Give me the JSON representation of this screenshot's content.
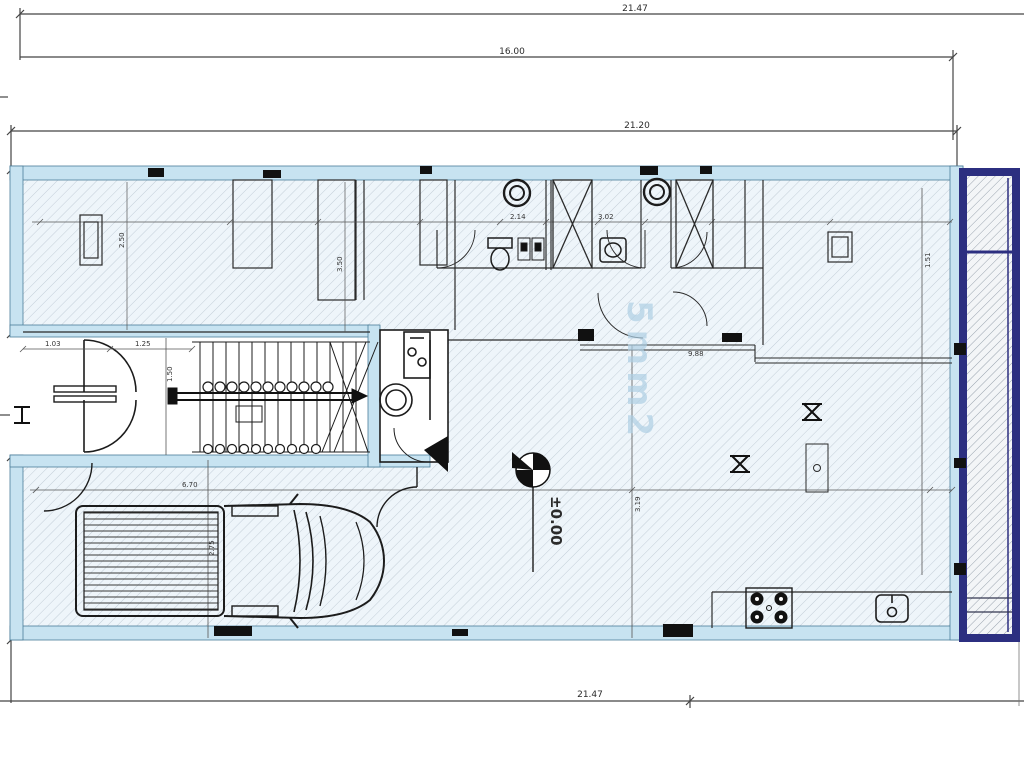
{
  "plan": {
    "watermark": "5mm2",
    "level_marker": "±0.00"
  },
  "labels": {
    "dim_overall_top": "21.47",
    "dim_upper": "16.00",
    "dim_inner_top": "21.20",
    "dim_overall_bottom": "21.47",
    "dim_hall_h": "2.50",
    "dim_hall_h2": "3.50",
    "dim_bath_1": "2.14",
    "dim_bath_2": "3.02",
    "dim_entry_1": "1.03",
    "dim_entry_2": "1.25",
    "dim_stair": "1.50",
    "dim_garage": "6.70",
    "dim_living": "3.19",
    "dim_car": "2.75",
    "dim_ledge": "9.88",
    "dim_right": "1.51"
  },
  "colors": {
    "wall_light_blue": "#c7e3f1",
    "shaft_navy": "#2c2f80",
    "hatch_line": "#c3ced8",
    "line_dark": "#2a2a2a"
  }
}
